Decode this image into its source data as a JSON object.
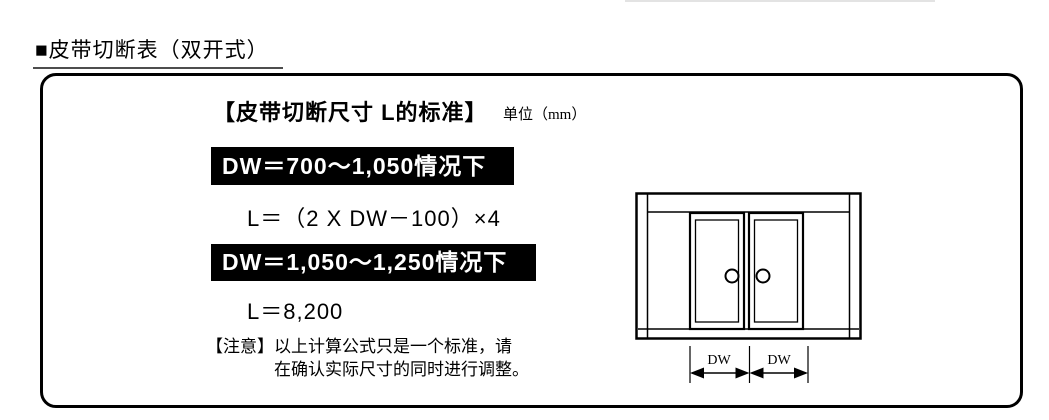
{
  "title": "■皮带切断表（双开式）",
  "panel": {
    "heading": "【皮带切断尺寸 L的标准】",
    "unit": "单位（mm）",
    "cases": [
      {
        "condition": "DW＝700～1,050情况下",
        "formula": "L＝（2 X DW－100）×4"
      },
      {
        "condition": "DW＝1,050～1,250情况下",
        "formula": "L＝8,200"
      }
    ],
    "note_label": "【注意】",
    "note_line1": "以上计算公式只是一个标准，请",
    "note_line2": "在确认实际尺寸的同时进行调整。",
    "diagram": {
      "dim_label_left": "DW",
      "dim_label_right": "DW"
    }
  },
  "colors": {
    "banner_bg": "#000000",
    "banner_text": "#ffffff",
    "line": "#000000",
    "title_underline": "#4d4d4d"
  }
}
